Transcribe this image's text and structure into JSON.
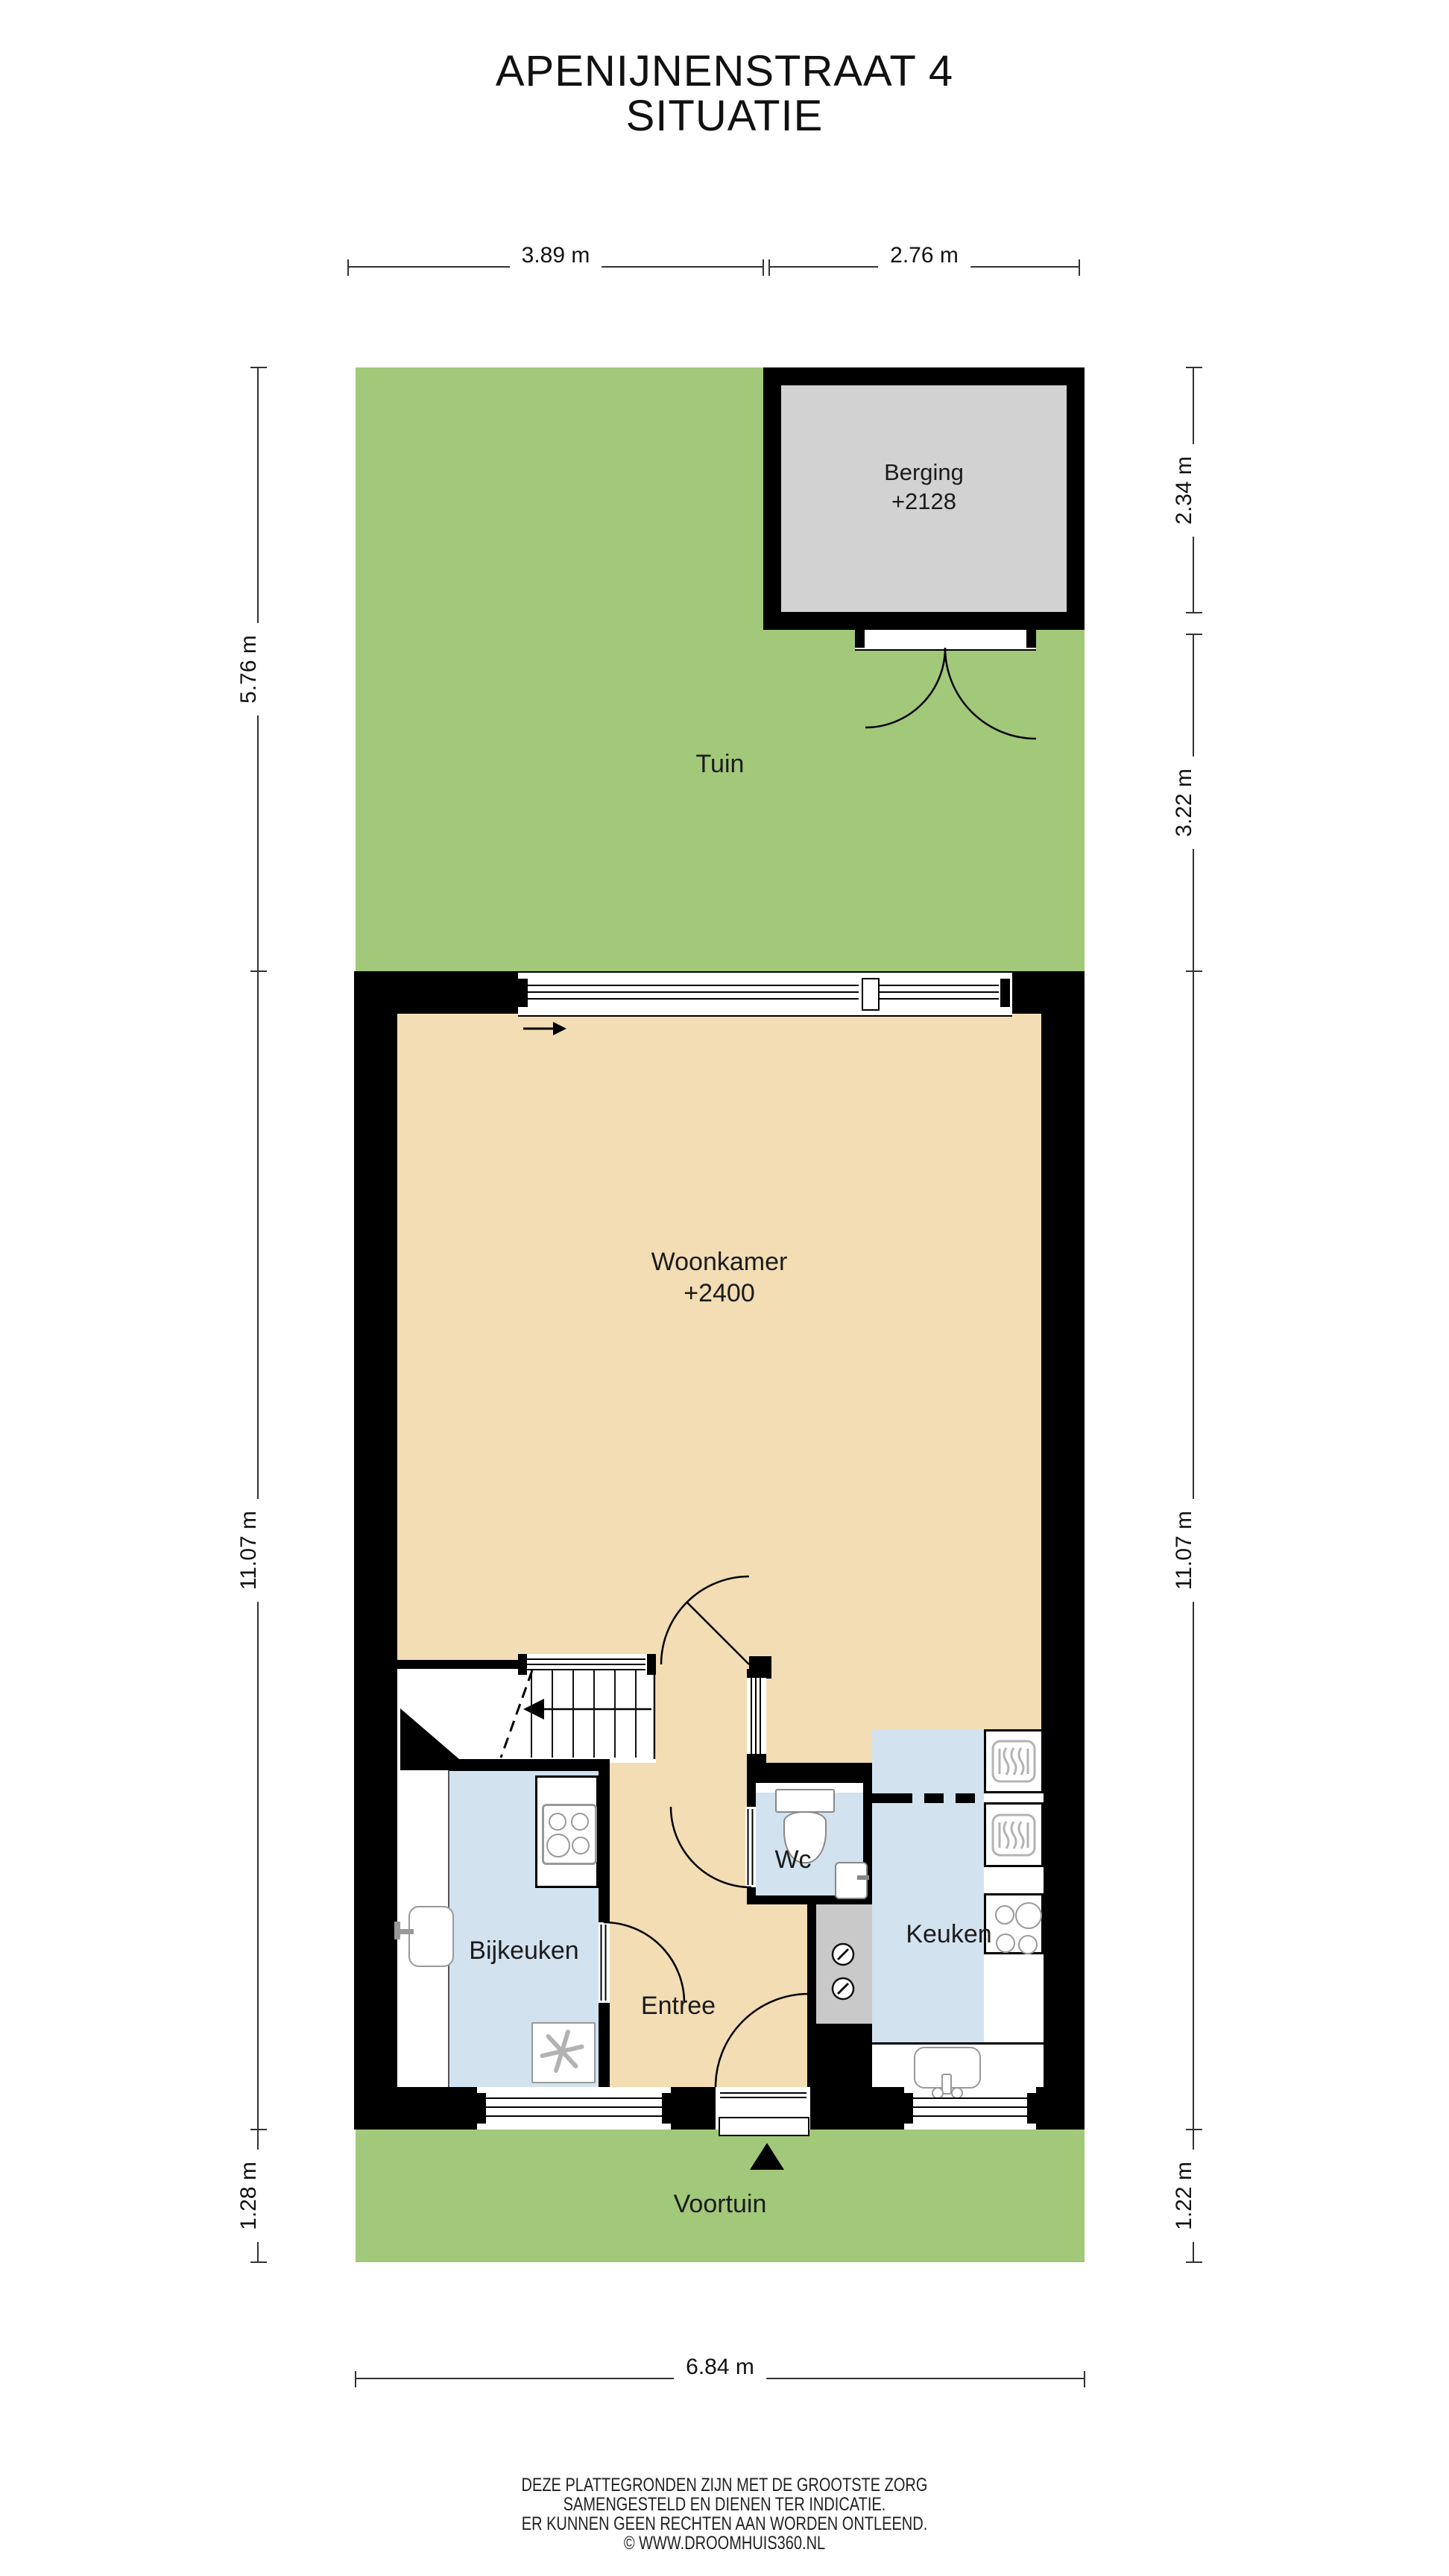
{
  "title": {
    "line1": "APENIJNENSTRAAT 4",
    "line2": "SITUATIE"
  },
  "rooms": {
    "tuin": "Tuin",
    "berging": {
      "name": "Berging",
      "level": "+2128"
    },
    "woonkamer": {
      "name": "Woonkamer",
      "level": "+2400"
    },
    "bijkeuken": "Bijkeuken",
    "entree": "Entree",
    "wc": "Wc",
    "keuken": "Keuken",
    "voortuin": "Voortuin"
  },
  "dimensions": {
    "top": [
      "3.89 m",
      "2.76 m"
    ],
    "left": [
      "5.76 m",
      "11.07 m",
      "1.28 m"
    ],
    "right": [
      "2.34 m",
      "3.22 m",
      "11.07 m",
      "1.22 m"
    ],
    "bottom": [
      "6.84 m"
    ]
  },
  "footer": {
    "line1": "DEZE PLATTEGRONDEN ZIJN MET DE GROOTSTE ZORG",
    "line2": "SAMENGESTELD EN DIENEN TER INDICATIE.",
    "line3": "ER KUNNEN GEEN RECHTEN AAN WORDEN ONTLEEND.",
    "line4": "© WWW.DROOMHUIS360.NL"
  },
  "icons": {
    "entrance_marker": "triangle-up",
    "stairs_direction": "arrow-left",
    "sliding_door_direction": "arrow-right",
    "hob": "four-burner-circles",
    "oven": "rounded-square-heat-waves",
    "ventilation": "pinwheel",
    "meters": "dial-circles"
  },
  "colors": {
    "garden": "#a2c87a",
    "floor_tan": "#f2ddb4",
    "floor_blue": "#d2e2ef",
    "floor_gray": "#d2d2d2",
    "cabinet_gray": "#c9c9c9",
    "wall": "#000000"
  }
}
